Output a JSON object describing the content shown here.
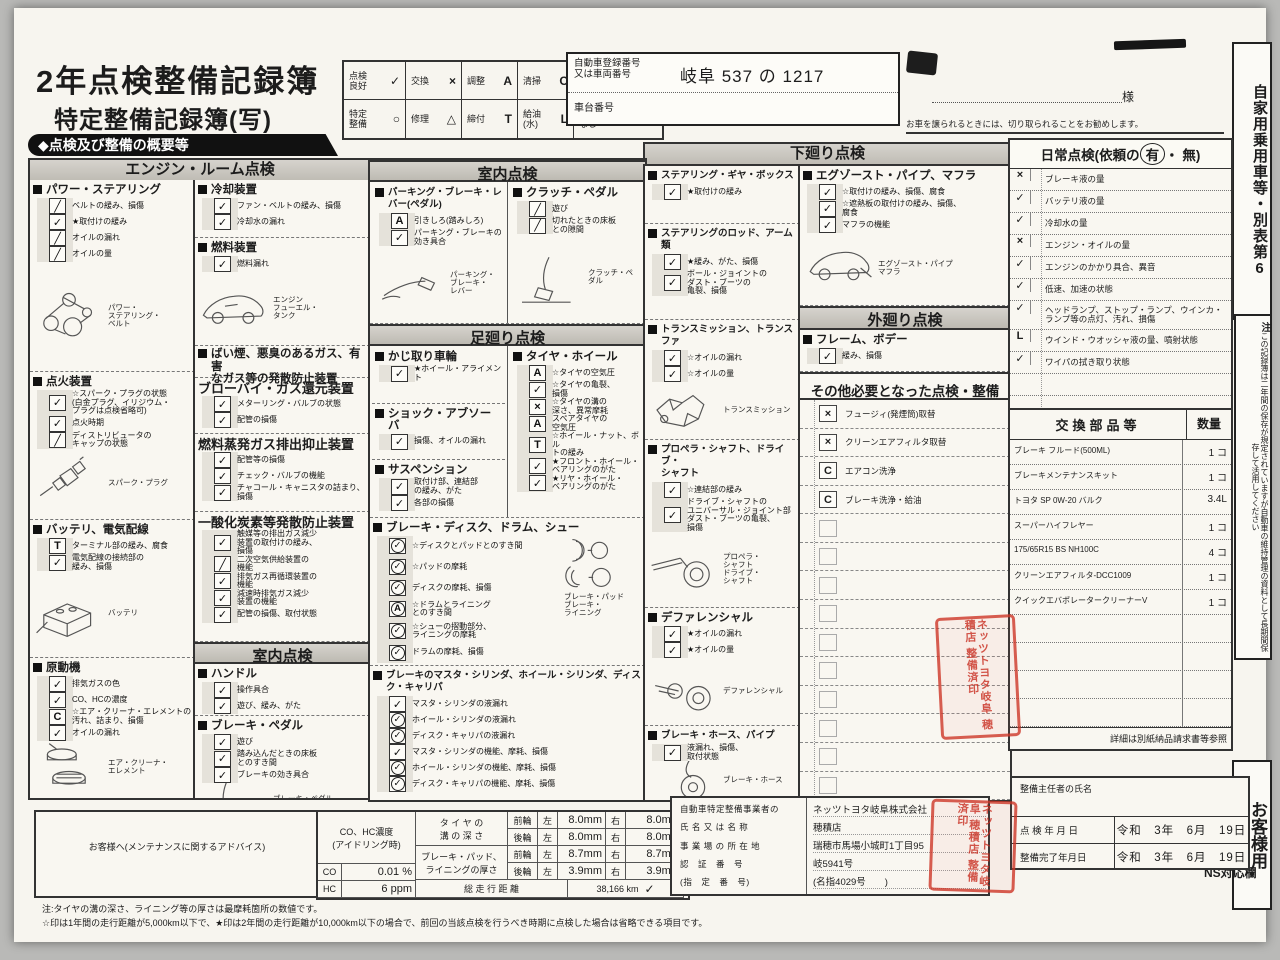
{
  "page": {
    "title1": "2年点検整備記録簿",
    "title2": "特定整備記録簿(写)",
    "overview_banner": "◆点検及び整備の概要等",
    "customer_suffix": "様",
    "cut_note": "お車を譲られるときには、切り取られることをお勧めします。",
    "side_top": "自家用乗用車等・別表第6",
    "side_note_mark": "注",
    "side_note": "この記録簿は二年間の保存が規定されていますが自動車の維持管理の資料として長期間保存して活用してください",
    "side_bottom": "お客様用",
    "ns_label": "NS対応欄",
    "footnote1": "注:タイヤの溝の深さ、ライニング等の厚さは最摩耗箇所の数値です。",
    "footnote2": "☆印は1年間の走行距離が5,000km以下で、★印は2年間の走行距離が10,000km以下の場合で、前回の当該点検を行うべき時期に点検した場合は省略できる項目です。"
  },
  "legend": {
    "rows": [
      [
        {
          "label": "点検\n良好",
          "mark": "✓"
        },
        {
          "label": "交換",
          "mark": "×"
        },
        {
          "label": "調整",
          "mark": "A"
        },
        {
          "label": "清掃",
          "mark": "C"
        },
        {
          "label": "省略",
          "mark": "P"
        }
      ],
      [
        {
          "label": "特定\n整備",
          "mark": "○"
        },
        {
          "label": "修理",
          "mark": "△"
        },
        {
          "label": "締付",
          "mark": "T"
        },
        {
          "label": "給油\n(水)",
          "mark": "L"
        },
        {
          "label": "該当\nなし",
          "mark": "╱"
        }
      ]
    ]
  },
  "registration": {
    "label1": "自動車登録番号\n又は車両番号",
    "value1": "岐阜 537 の 1217",
    "label2": "車台番号",
    "value2": ""
  },
  "banners": {
    "engine": "エンジン・ルーム点検",
    "under": "下廻り点検"
  },
  "columns": {
    "col1": [
      {
        "t": "group",
        "title": "パワー・ステアリング",
        "h": 192,
        "items": [
          {
            "m": "╱",
            "t": "ベルトの緩み、損傷"
          },
          {
            "m": "✓",
            "t": "★取付けの緩み"
          },
          {
            "m": "╱",
            "t": "オイルの漏れ"
          },
          {
            "m": "╱",
            "t": "オイルの量"
          }
        ],
        "illus": {
          "kind": "belt",
          "labels": [
            "パワー・\nステアリング・\nベルト"
          ]
        }
      },
      {
        "t": "group",
        "title": "点火装置",
        "h": 148,
        "items": [
          {
            "m": "✓",
            "t": "☆スパーク・プラグの状態\n(白金プラグ、イリジウム・\nプラグは点検省略可)"
          },
          {
            "m": "✓",
            "t": "点火時期"
          },
          {
            "m": "╱",
            "t": "ディストリビュータの\nキャップの状態"
          }
        ],
        "illus": {
          "kind": "plug",
          "labels": [
            "スパーク・プラグ"
          ]
        }
      },
      {
        "t": "group",
        "title": "バッテリ、電気配線",
        "h": 138,
        "items": [
          {
            "m": "T",
            "t": "ターミナル部の緩み、腐食"
          },
          {
            "m": "✓",
            "t": "電気配線の接続部の\n緩み、損傷"
          }
        ],
        "illus": {
          "kind": "battery",
          "labels": [
            "バッテリ"
          ]
        }
      },
      {
        "t": "group",
        "title": "原動機",
        "h": 136,
        "items": [
          {
            "m": "✓",
            "t": "排気ガスの色"
          },
          {
            "m": "✓",
            "t": "CO、HCの濃度"
          },
          {
            "m": "C",
            "t": "☆エア・クリーナ・エレメントの\n汚れ、詰まり、損傷"
          },
          {
            "m": "✓",
            "t": "オイルの漏れ"
          }
        ],
        "illus": {
          "kind": "aircleaner",
          "labels": [
            "エア・クリーナ・\nエレメント"
          ]
        }
      }
    ],
    "col2": [
      {
        "t": "group",
        "title": "冷却装置",
        "h": 58,
        "items": [
          {
            "m": "✓",
            "t": "ファン・ベルトの緩み、損傷"
          },
          {
            "m": "✓",
            "t": "冷却水の漏れ"
          }
        ]
      },
      {
        "t": "group",
        "title": "燃料装置",
        "h": 108,
        "items": [
          {
            "m": "✓",
            "t": "燃料漏れ"
          }
        ],
        "illus": {
          "kind": "car",
          "labels": [
            "エンジン",
            "フューエル・\nタンク"
          ]
        }
      },
      {
        "t": "head2",
        "title": "ばい煙、悪臭のあるガス、有害\nなガス等の発散防止装置",
        "h": 32
      },
      {
        "t": "group",
        "title2": "ブローバイ・ガス還元装置",
        "h": 56,
        "items": [
          {
            "m": "✓",
            "t": "メターリング・バルブの状態"
          },
          {
            "m": "✓",
            "t": "配管の損傷"
          }
        ]
      },
      {
        "t": "group",
        "title2": "燃料蒸発ガス排出抑止装置",
        "h": 78,
        "items": [
          {
            "m": "✓",
            "t": "配管等の損傷"
          },
          {
            "m": "✓",
            "t": "チェック・バルブの機能"
          },
          {
            "m": "✓",
            "t": "チャコール・キャニスタの詰まり、\n損傷"
          }
        ]
      },
      {
        "t": "group",
        "title2": "一酸化炭素等発散防止装置",
        "h": 130,
        "items": [
          {
            "m": "✓",
            "t": "触媒等の排出ガス減少\n装置の取付けの緩み、\n損傷"
          },
          {
            "m": "╱",
            "t": "二次空気供給装置の\n機能"
          },
          {
            "m": "✓",
            "t": "排気ガス再循環装置の\n機能"
          },
          {
            "m": "✓",
            "t": "減速時排気ガス減少\n装置の機能"
          },
          {
            "m": "✓",
            "t": "配管の損傷、取付状態"
          }
        ]
      },
      {
        "t": "banner",
        "title": "室内点検",
        "h": 24
      },
      {
        "t": "group",
        "title": "ハンドル",
        "h": 52,
        "items": [
          {
            "m": "✓",
            "t": "操作具合"
          },
          {
            "m": "✓",
            "t": "遊び、緩み、がた"
          }
        ]
      },
      {
        "t": "group",
        "title": "ブレーキ・ペダル",
        "h": 100,
        "items": [
          {
            "m": "✓",
            "t": "遊び"
          },
          {
            "m": "✓",
            "t": "踏み込んだときの床板\nとのすき間"
          },
          {
            "m": "✓",
            "t": "ブレーキの効き具合"
          }
        ],
        "illus": {
          "kind": "pedal",
          "labels": [
            "ブレーキ・ペダル"
          ]
        }
      }
    ],
    "col3": [
      {
        "t": "banner",
        "title": "室内点検",
        "h": 24
      },
      {
        "t": "pair",
        "h": 142,
        "left": [
          {
            "title": "パーキング・ブレーキ・レバー(ペダル)",
            "small": true,
            "items": [
              {
                "m": "A",
                "t": "引きしろ(踏みしろ)"
              },
              {
                "m": "✓",
                "t": "パーキング・ブレーキの\n効き具合"
              }
            ],
            "illus": {
              "kind": "lever",
              "labels": [
                "パーキング・\nブレーキ・\nレバー"
              ]
            }
          }
        ],
        "right": [
          {
            "title": "クラッチ・ペダル",
            "items": [
              {
                "m": "╱",
                "t": "遊び"
              },
              {
                "m": "╱",
                "t": "切れたときの床板\nとの隙間"
              }
            ],
            "illus": {
              "kind": "clutch",
              "labels": [
                "クラッチ・ペダル"
              ]
            }
          }
        ]
      },
      {
        "t": "banner",
        "title": "足廻り点検",
        "h": 24
      },
      {
        "t": "pair",
        "h": 172,
        "left": [
          {
            "title": "かじ取り車輪",
            "items": [
              {
                "m": "✓",
                "t": "★ホイール・アライメント"
              }
            ]
          },
          {
            "title": "ショック・アブソーバ",
            "items": [
              {
                "m": "✓",
                "t": "損傷、オイルの漏れ"
              }
            ]
          },
          {
            "title": "サスペンション",
            "items": [
              {
                "m": "✓",
                "t": "取付け部、連結部\nの緩み、がた"
              },
              {
                "m": "✓",
                "t": "各部の損傷"
              }
            ]
          }
        ],
        "right": [
          {
            "title": "タイヤ・ホイール",
            "items": [
              {
                "m": "A",
                "t": "☆タイヤの空気圧"
              },
              {
                "m": "✓",
                "t": "☆タイヤの亀裂、\n損傷"
              },
              {
                "m": "×",
                "t": "☆タイヤの溝の\n深さ、異常摩耗"
              },
              {
                "m": "A",
                "t": "スペアタイヤの\n空気圧"
              },
              {
                "m": "T",
                "t": "☆ホイール・ナット、ボル\nトの緩み"
              },
              {
                "m": "✓",
                "t": "★フロント・ホイール・\nベアリングのがた"
              },
              {
                "m": "✓",
                "t": "★リヤ・ホイール・\nベアリングのがた"
              }
            ]
          }
        ]
      },
      {
        "t": "group",
        "title": "ブレーキ・ディスク、ドラム、シュー",
        "h": 148,
        "side": true,
        "items": [
          {
            "m": "(✓)",
            "t": "☆ディスクとパッドとのすき間"
          },
          {
            "m": "(✓)",
            "t": "☆パッドの摩耗"
          },
          {
            "m": "(✓)",
            "t": "ディスクの摩耗、損傷"
          },
          {
            "m": "(A)",
            "t": "☆ドラムとライニング\nとのすき間"
          },
          {
            "m": "(✓)",
            "t": "☆シューの摺動部分、\nライニングの摩耗"
          },
          {
            "m": "(✓)",
            "t": "ドラムの摩耗、損傷"
          }
        ],
        "illus": {
          "kind": "brakepads",
          "labels": [
            "ブレーキ・パッド",
            "ブレーキ・\nライニング"
          ]
        }
      },
      {
        "t": "group",
        "title": "ブレーキのマスタ・シリンダ、ホイール・シリンダ、ディスク・キャリパ",
        "small": true,
        "h": 184,
        "items": [
          {
            "m": "✓",
            "t": "マスタ・シリンダの液漏れ"
          },
          {
            "m": "(✓)",
            "t": "ホイール・シリンダの液漏れ"
          },
          {
            "m": "(✓)",
            "t": "ディスク・キャリパの液漏れ"
          },
          {
            "m": "✓",
            "t": "マスタ・シリンダの機能、摩耗、損傷"
          },
          {
            "m": "(✓)",
            "t": "ホイール・シリンダの機能、摩耗、損傷"
          },
          {
            "m": "(✓)",
            "t": "ディスク・キャリパの機能、摩耗、損傷"
          }
        ],
        "illus": {
          "kind": "master",
          "labels": [
            "マスタ・シリンダ",
            "ディスク・\nキャリパ"
          ]
        }
      }
    ],
    "col4": [
      {
        "t": "group",
        "title": "ステアリング・ギヤ・ボックス",
        "small": true,
        "h": 58,
        "items": [
          {
            "m": "✓",
            "t": "★取付けの緩み"
          }
        ]
      },
      {
        "t": "group",
        "title": "ステアリングのロッド、アーム類",
        "small": true,
        "h": 96,
        "items": [
          {
            "m": "✓",
            "t": "★緩み、がた、損傷"
          },
          {
            "m": "✓",
            "t": "ボール・ジョイントの\nダスト・ブーツの\n亀裂、損傷"
          }
        ]
      },
      {
        "t": "group",
        "title": "トランスミッション、トランスファ",
        "small": true,
        "h": 120,
        "items": [
          {
            "m": "✓",
            "t": "☆オイルの漏れ"
          },
          {
            "m": "✓",
            "t": "☆オイルの量"
          }
        ],
        "illus": {
          "kind": "trans",
          "labels": [
            "トランスミッション"
          ]
        }
      },
      {
        "t": "group",
        "title": "プロペラ・シャフト、ドライブ・\nシャフト",
        "small": true,
        "h": 168,
        "items": [
          {
            "m": "✓",
            "t": "☆連結部の緩み"
          },
          {
            "m": "✓",
            "t": "ドライブ・シャフトの\nユニバーサル・ジョイント部\nダスト・ブーツの亀裂、\n損傷"
          }
        ],
        "illus": {
          "kind": "shaft",
          "labels": [
            "プロペラ・\nシャフト",
            "ドライブ・\nシャフト"
          ]
        }
      },
      {
        "t": "group",
        "title": "デファレンシャル",
        "h": 118,
        "items": [
          {
            "m": "✓",
            "t": "★オイルの漏れ"
          },
          {
            "m": "✓",
            "t": "★オイルの量"
          }
        ],
        "illus": {
          "kind": "diff",
          "labels": [
            "デファレンシャル"
          ]
        }
      },
      {
        "t": "group",
        "title": "ブレーキ・ホース、パイプ",
        "small": true,
        "h": 74,
        "items": [
          {
            "m": "✓",
            "t": "液漏れ、損傷、\n取付状態"
          }
        ],
        "illus": {
          "kind": "hose",
          "labels": [
            "ブレーキ・ホース"
          ]
        }
      }
    ],
    "col5": [
      {
        "t": "group",
        "title": "エグゾースト・パイプ、マフラ",
        "h": 140,
        "items": [
          {
            "m": "✓",
            "t": "☆取付けの緩み、損傷、腐食"
          },
          {
            "m": "✓",
            "t": "☆遮熱板の取付けの緩み、損傷、\n腐食"
          },
          {
            "m": "✓",
            "t": "マフラの機能"
          }
        ],
        "illus": {
          "kind": "excar",
          "labels": [
            "エグゾースト・パイプ",
            "マフラ"
          ]
        }
      },
      {
        "t": "banner",
        "title": "外廻り点検",
        "h": 26
      },
      {
        "t": "group",
        "title": "フレーム、ボデー",
        "h": 42,
        "items": [
          {
            "m": "✓",
            "t": "緩み、損傷"
          }
        ]
      },
      {
        "t": "head3",
        "title": "その他必要となった点検・整備",
        "h": 28
      },
      {
        "t": "rows",
        "h": 396,
        "items": [
          {
            "m": "×",
            "t": "フュージィ(発煙筒)取替"
          },
          {
            "m": "×",
            "t": "クリーンエアフィルタ取替"
          },
          {
            "m": "C",
            "t": "エアコン洗浄"
          },
          {
            "m": "◎",
            "t": "ブレーキ洗浄・給油"
          },
          {
            "m": "",
            "t": ""
          },
          {
            "m": "",
            "t": ""
          },
          {
            "m": "",
            "t": ""
          },
          {
            "m": "",
            "t": ""
          },
          {
            "m": "",
            "t": ""
          },
          {
            "m": "",
            "t": ""
          },
          {
            "m": "",
            "t": ""
          },
          {
            "m": "",
            "t": ""
          },
          {
            "m": "",
            "t": ""
          },
          {
            "m": "",
            "t": ""
          }
        ]
      }
    ]
  },
  "daily": {
    "head_pre": "日常点検(依頼の",
    "yes": "有",
    "dot": "・",
    "no": "無",
    "head_post": ")",
    "items": [
      {
        "m": "×",
        "t": "ブレーキ液の量"
      },
      {
        "m": "✓",
        "t": "バッテリ液の量"
      },
      {
        "m": "✓",
        "t": "冷却水の量"
      },
      {
        "m": "×",
        "t": "エンジン・オイルの量"
      },
      {
        "m": "✓",
        "t": "エンジンのかかり具合、異音"
      },
      {
        "m": "✓",
        "t": "低速、加速の状態"
      },
      {
        "m": "✓",
        "t": "ヘッドランプ、ストップ・ランプ、ウインカ・\nランプ等の点灯、汚れ、損傷"
      },
      {
        "m": "L",
        "t": "ウインド・ウオッシャ液の量、噴射状態"
      },
      {
        "m": "✓",
        "t": "ワイパの拭き取り状態"
      },
      {
        "m": "",
        "t": ""
      },
      {
        "m": "",
        "t": ""
      }
    ]
  },
  "parts": {
    "header": "交換部品等",
    "qty_header": "数量",
    "rows": [
      {
        "name": "ブレーキ フルード(500ML)",
        "qty": "1 コ"
      },
      {
        "name": "ブレーキメンテナンスキット",
        "qty": "1 コ"
      },
      {
        "name": "トヨタ SP 0W-20 バルク",
        "qty": "3.4L"
      },
      {
        "name": "スーパーハイフレヤー",
        "qty": "1 コ"
      },
      {
        "name": "175/65R15 BS NH100C",
        "qty": "4 コ"
      },
      {
        "name": "クリーンエアフィルタ-DCC1009",
        "qty": "1 コ"
      },
      {
        "name": "クイックエバポレータークリーナーV",
        "qty": "1 コ"
      },
      {
        "name": "",
        "qty": ""
      },
      {
        "name": "",
        "qty": ""
      },
      {
        "name": "",
        "qty": ""
      },
      {
        "name": "",
        "qty": ""
      }
    ],
    "note": "詳細は別紙納品請求書等参照"
  },
  "dates": {
    "chief_label": "整備主任者の氏名",
    "insp_label": "点 検 年 月 日",
    "done_label": "整備完了年月日",
    "insp_value": "令和　3年　6月　19日",
    "done_value": "令和　3年　6月　19日"
  },
  "advice": {
    "label": "お客様へ(メンテナンスに関するアドバイス)"
  },
  "measure": {
    "co_header": "CO、HC濃度\n(アイドリング時)",
    "co_label": "CO",
    "co_value": "0.01",
    "co_unit": "%",
    "hc_label": "HC",
    "hc_value": "6",
    "hc_unit": "ppm",
    "tire_label": "タ イ ヤ の\n溝 の 深 さ",
    "pad_label": "ブレーキ・パッド、\nライニングの厚さ",
    "odo_label": "総 走 行 距 離",
    "odo_value": "38,166 km",
    "odo_check": "✓",
    "front": "前輪",
    "rear": "後輪",
    "left": "左",
    "right": "右",
    "tire_front": [
      "8.0mm",
      "8.0mm"
    ],
    "tire_rear": [
      "8.0mm",
      "8.0mm"
    ],
    "pad_front": [
      "8.7mm",
      "8.7mm"
    ],
    "pad_rear": [
      "3.9mm",
      "3.9mm"
    ]
  },
  "business": {
    "labels": [
      "自動車特定整備事業者の",
      "氏 名 又 は 名 称",
      "事 業 場 の 所 在 地",
      "認　証　番　号",
      "(指　定　番　号)"
    ],
    "values": [
      "ネッツトヨタ岐阜株式会社",
      "穂積店",
      "瑞穂市馬場小城町1丁目95",
      "岐5941号",
      "(名指4029号　　)"
    ]
  },
  "seal": {
    "text": "ネッツトヨタ岐阜 穂積店 整備済印"
  }
}
